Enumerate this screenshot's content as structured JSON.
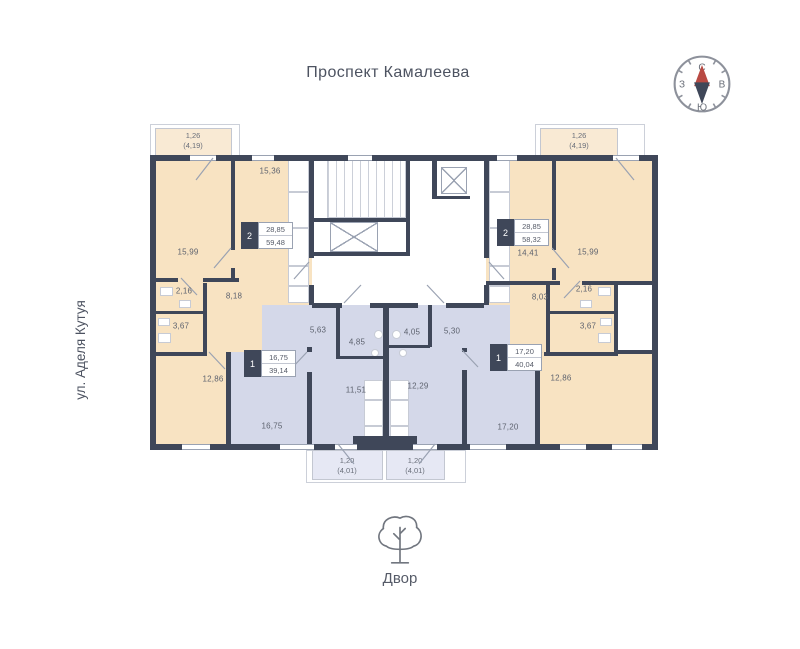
{
  "title": "Проспект Камалеева",
  "street": "ул. Аделя Кутуя",
  "courtyard": "Двор",
  "compass": {
    "north": "С",
    "east": "В",
    "south": "Ю",
    "west": "З"
  },
  "colors": {
    "wall": "#3f4759",
    "beige": "#f8e3c2",
    "beige_light": "#f9ead4",
    "blue": "#d4d8e9",
    "blue_light": "#e6e8f4",
    "white": "#ffffff",
    "accent_red": "#b94a43",
    "line": "#9aa2b2",
    "text": "#5d626e"
  },
  "apartment_badges": [
    {
      "rooms": "2",
      "living_area": "28,85",
      "total_area": "59,48",
      "x": 241,
      "y": 222
    },
    {
      "rooms": "2",
      "living_area": "28,85",
      "total_area": "58,32",
      "x": 497,
      "y": 219
    },
    {
      "rooms": "1",
      "living_area": "16,75",
      "total_area": "39,14",
      "x": 244,
      "y": 350
    },
    {
      "rooms": "1",
      "living_area": "17,20",
      "total_area": "40,04",
      "x": 490,
      "y": 344
    }
  ],
  "room_labels": [
    {
      "text": "15,36",
      "x": 270,
      "y": 171
    },
    {
      "text": "15,99",
      "x": 188,
      "y": 252
    },
    {
      "text": "2,16",
      "x": 184,
      "y": 291
    },
    {
      "text": "8,18",
      "x": 234,
      "y": 296
    },
    {
      "text": "3,67",
      "x": 181,
      "y": 326
    },
    {
      "text": "12,86",
      "x": 213,
      "y": 379
    },
    {
      "text": "14,41",
      "x": 528,
      "y": 253
    },
    {
      "text": "15,99",
      "x": 588,
      "y": 252
    },
    {
      "text": "2,16",
      "x": 584,
      "y": 289
    },
    {
      "text": "8,03",
      "x": 540,
      "y": 297
    },
    {
      "text": "3,67",
      "x": 588,
      "y": 326
    },
    {
      "text": "12,86",
      "x": 561,
      "y": 378
    },
    {
      "text": "5,63",
      "x": 318,
      "y": 330
    },
    {
      "text": "4,85",
      "x": 357,
      "y": 342
    },
    {
      "text": "11,51",
      "x": 356,
      "y": 390
    },
    {
      "text": "16,75",
      "x": 272,
      "y": 426
    },
    {
      "text": "4,05",
      "x": 412,
      "y": 332
    },
    {
      "text": "5,30",
      "x": 452,
      "y": 331
    },
    {
      "text": "12,29",
      "x": 418,
      "y": 386
    },
    {
      "text": "17,20",
      "x": 508,
      "y": 427
    }
  ],
  "plan": {
    "regions": [
      {
        "name": "building-base",
        "fill": "white",
        "x": 150,
        "y": 155,
        "w": 508,
        "h": 295
      },
      {
        "name": "apartment-2-left-top",
        "fill": "beige",
        "x": 150,
        "y": 155,
        "w": 162,
        "h": 150
      },
      {
        "name": "apartment-1-left",
        "fill": "blue",
        "x": 228,
        "y": 305,
        "w": 156,
        "h": 139
      },
      {
        "name": "apartment-2-left-mid",
        "fill": "beige",
        "x": 150,
        "y": 280,
        "w": 112,
        "h": 72
      },
      {
        "name": "apartment-2-left-bottom",
        "fill": "beige",
        "x": 150,
        "y": 352,
        "w": 78,
        "h": 92
      },
      {
        "name": "apartment-2-right-top",
        "fill": "beige",
        "x": 486,
        "y": 155,
        "w": 172,
        "h": 150
      },
      {
        "name": "apartment-1-right",
        "fill": "blue",
        "x": 384,
        "y": 305,
        "w": 154,
        "h": 139
      },
      {
        "name": "apartment-2-right-mid",
        "fill": "beige",
        "x": 510,
        "y": 284,
        "w": 108,
        "h": 68
      },
      {
        "name": "apartment-2-right-bottom",
        "fill": "beige",
        "x": 538,
        "y": 352,
        "w": 120,
        "h": 92
      },
      {
        "name": "shaft-notch",
        "fill": "white",
        "x": 618,
        "y": 284,
        "w": 36,
        "h": 66
      }
    ],
    "balconies": [
      {
        "area": "1,26",
        "area_total": "(4,19)",
        "x": 155,
        "y": 128,
        "w": 77,
        "h": 29,
        "fill": "beige_light",
        "lx": 193,
        "ly": 141,
        "ox": 150,
        "oy": 124,
        "ow": 90,
        "oh": 32
      },
      {
        "area": "1,26",
        "area_total": "(4,19)",
        "x": 540,
        "y": 128,
        "w": 78,
        "h": 29,
        "fill": "beige_light",
        "lx": 579,
        "ly": 141,
        "ox": 535,
        "oy": 124,
        "ow": 110,
        "oh": 32
      },
      {
        "area": "1,20",
        "area_total": "(4,01)",
        "x": 312,
        "y": 450,
        "w": 71,
        "h": 30,
        "fill": "blue_light",
        "lx": 347,
        "ly": 466,
        "ox": 306,
        "oy": 450,
        "ow": 160,
        "oh": 33
      },
      {
        "area": "1,20",
        "area_total": "(4,01)",
        "x": 386,
        "y": 450,
        "w": 59,
        "h": 30,
        "fill": "blue_light",
        "lx": 415,
        "ly": 466
      }
    ],
    "stairs": {
      "x": 327,
      "y": 158,
      "w": 79,
      "h": 60
    },
    "elevators": [
      {
        "x": 441,
        "y": 167,
        "w": 26,
        "h": 27
      },
      {
        "x": 330,
        "y": 222,
        "w": 48,
        "h": 30
      }
    ],
    "walls": [
      {
        "x": 150,
        "y": 155,
        "w": 508,
        "h": 6
      },
      {
        "x": 150,
        "y": 444,
        "w": 508,
        "h": 6
      },
      {
        "x": 150,
        "y": 155,
        "w": 6,
        "h": 295
      },
      {
        "x": 652,
        "y": 155,
        "w": 6,
        "h": 295
      },
      {
        "x": 309,
        "y": 155,
        "w": 5,
        "h": 103
      },
      {
        "x": 309,
        "y": 285,
        "w": 5,
        "h": 20
      },
      {
        "x": 484,
        "y": 155,
        "w": 5,
        "h": 103
      },
      {
        "x": 484,
        "y": 285,
        "w": 5,
        "h": 20
      },
      {
        "x": 406,
        "y": 155,
        "w": 4,
        "h": 100
      },
      {
        "x": 312,
        "y": 218,
        "w": 98,
        "h": 4
      },
      {
        "x": 312,
        "y": 252,
        "w": 98,
        "h": 4
      },
      {
        "x": 432,
        "y": 161,
        "w": 5,
        "h": 38
      },
      {
        "x": 436,
        "y": 196,
        "w": 34,
        "h": 3
      },
      {
        "x": 312,
        "y": 303,
        "w": 30,
        "h": 5
      },
      {
        "x": 370,
        "y": 303,
        "w": 48,
        "h": 5
      },
      {
        "x": 446,
        "y": 303,
        "w": 38,
        "h": 5
      },
      {
        "x": 231,
        "y": 155,
        "w": 4,
        "h": 95
      },
      {
        "x": 231,
        "y": 268,
        "w": 4,
        "h": 12
      },
      {
        "x": 150,
        "y": 278,
        "w": 28,
        "h": 4
      },
      {
        "x": 203,
        "y": 278,
        "w": 36,
        "h": 4
      },
      {
        "x": 203,
        "y": 283,
        "w": 4,
        "h": 70
      },
      {
        "x": 150,
        "y": 311,
        "w": 57,
        "h": 3
      },
      {
        "x": 150,
        "y": 352,
        "w": 57,
        "h": 4
      },
      {
        "x": 226,
        "y": 352,
        "w": 5,
        "h": 92
      },
      {
        "x": 552,
        "y": 155,
        "w": 4,
        "h": 95
      },
      {
        "x": 552,
        "y": 268,
        "w": 4,
        "h": 12
      },
      {
        "x": 486,
        "y": 281,
        "w": 74,
        "h": 4
      },
      {
        "x": 582,
        "y": 281,
        "w": 76,
        "h": 4
      },
      {
        "x": 546,
        "y": 283,
        "w": 4,
        "h": 70
      },
      {
        "x": 546,
        "y": 311,
        "w": 72,
        "h": 3
      },
      {
        "x": 544,
        "y": 352,
        "w": 74,
        "h": 4
      },
      {
        "x": 535,
        "y": 352,
        "w": 5,
        "h": 92
      },
      {
        "x": 614,
        "y": 283,
        "w": 4,
        "h": 70
      },
      {
        "x": 614,
        "y": 350,
        "w": 40,
        "h": 4
      },
      {
        "x": 336,
        "y": 305,
        "w": 4,
        "h": 52
      },
      {
        "x": 336,
        "y": 356,
        "w": 47,
        "h": 3
      },
      {
        "x": 428,
        "y": 305,
        "w": 4,
        "h": 42
      },
      {
        "x": 388,
        "y": 345,
        "w": 42,
        "h": 3
      },
      {
        "x": 307,
        "y": 347,
        "w": 5,
        "h": 5
      },
      {
        "x": 307,
        "y": 372,
        "w": 5,
        "h": 72
      },
      {
        "x": 462,
        "y": 348,
        "w": 5,
        "h": 4
      },
      {
        "x": 462,
        "y": 370,
        "w": 5,
        "h": 74
      },
      {
        "x": 383,
        "y": 305,
        "w": 6,
        "h": 139
      },
      {
        "x": 353,
        "y": 436,
        "w": 64,
        "h": 10
      }
    ],
    "windows": [
      {
        "x": 190,
        "y": 155,
        "w": 26
      },
      {
        "x": 252,
        "y": 155,
        "w": 22
      },
      {
        "x": 348,
        "y": 155,
        "w": 24
      },
      {
        "x": 497,
        "y": 155,
        "w": 20
      },
      {
        "x": 613,
        "y": 155,
        "w": 26
      },
      {
        "x": 182,
        "y": 444,
        "w": 28
      },
      {
        "x": 280,
        "y": 444,
        "w": 34
      },
      {
        "x": 335,
        "y": 444,
        "w": 22
      },
      {
        "x": 413,
        "y": 444,
        "w": 24
      },
      {
        "x": 470,
        "y": 444,
        "w": 36
      },
      {
        "x": 560,
        "y": 444,
        "w": 26
      },
      {
        "x": 612,
        "y": 444,
        "w": 30
      }
    ],
    "fixtures": [
      {
        "x": 288,
        "y": 160,
        "w": 21,
        "h": 32
      },
      {
        "x": 288,
        "y": 192,
        "w": 21,
        "h": 36
      },
      {
        "x": 288,
        "y": 228,
        "w": 21,
        "h": 38
      },
      {
        "x": 288,
        "y": 266,
        "w": 21,
        "h": 20
      },
      {
        "x": 288,
        "y": 286,
        "w": 21,
        "h": 17
      },
      {
        "x": 489,
        "y": 160,
        "w": 21,
        "h": 32
      },
      {
        "x": 489,
        "y": 192,
        "w": 21,
        "h": 36
      },
      {
        "x": 489,
        "y": 228,
        "w": 21,
        "h": 38
      },
      {
        "x": 489,
        "y": 266,
        "w": 21,
        "h": 20
      },
      {
        "x": 489,
        "y": 286,
        "w": 21,
        "h": 17
      },
      {
        "x": 364,
        "y": 380,
        "w": 19,
        "h": 20
      },
      {
        "x": 364,
        "y": 400,
        "w": 19,
        "h": 26
      },
      {
        "x": 364,
        "y": 426,
        "w": 19,
        "h": 12
      },
      {
        "x": 390,
        "y": 380,
        "w": 19,
        "h": 20
      },
      {
        "x": 390,
        "y": 400,
        "w": 19,
        "h": 26
      },
      {
        "x": 390,
        "y": 426,
        "w": 19,
        "h": 12
      },
      {
        "x": 160,
        "y": 287,
        "w": 13,
        "h": 9
      },
      {
        "x": 179,
        "y": 300,
        "w": 12,
        "h": 8
      },
      {
        "x": 158,
        "y": 318,
        "w": 12,
        "h": 8
      },
      {
        "x": 158,
        "y": 333,
        "w": 13,
        "h": 10
      },
      {
        "x": 598,
        "y": 287,
        "w": 13,
        "h": 9
      },
      {
        "x": 580,
        "y": 300,
        "w": 12,
        "h": 8
      },
      {
        "x": 600,
        "y": 318,
        "w": 12,
        "h": 8
      },
      {
        "x": 598,
        "y": 333,
        "w": 13,
        "h": 10
      },
      {
        "x": 374,
        "y": 330,
        "w": 9,
        "h": 9,
        "t": "c"
      },
      {
        "x": 371,
        "y": 349,
        "w": 8,
        "h": 8,
        "t": "c"
      },
      {
        "x": 392,
        "y": 330,
        "w": 9,
        "h": 9,
        "t": "c"
      },
      {
        "x": 399,
        "y": 349,
        "w": 8,
        "h": 8,
        "t": "c"
      }
    ],
    "doors": [
      [
        213,
        158,
        196,
        180
      ],
      [
        616,
        158,
        634,
        180
      ],
      [
        338,
        444,
        354,
        464
      ],
      [
        435,
        444,
        419,
        464
      ],
      [
        231,
        248,
        214,
        268
      ],
      [
        552,
        248,
        569,
        268
      ],
      [
        309,
        262,
        294,
        279
      ],
      [
        489,
        262,
        504,
        279
      ],
      [
        344,
        303,
        361,
        285
      ],
      [
        444,
        303,
        427,
        285
      ],
      [
        307,
        352,
        291,
        369
      ],
      [
        462,
        350,
        478,
        367
      ],
      [
        209,
        352,
        225,
        369
      ],
      [
        542,
        352,
        526,
        369
      ],
      [
        181,
        278,
        197,
        295
      ],
      [
        580,
        281,
        564,
        298
      ]
    ]
  }
}
